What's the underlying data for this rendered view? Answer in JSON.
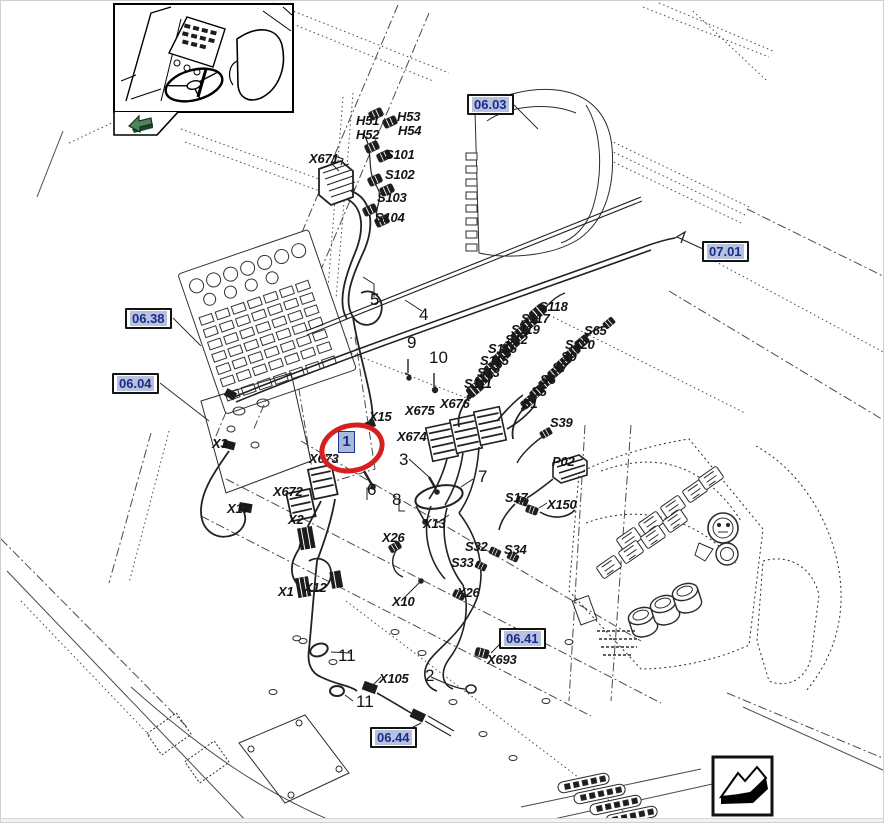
{
  "figure": {
    "type": "wiring-harness-parts-diagram",
    "highlight_callout": {
      "item_label": "1",
      "oval_color": "#d81f1f",
      "label_fill": "#a9b9d9",
      "label_text_color": "#1b2a8c"
    },
    "ref_boxes": [
      {
        "label": "06.03",
        "x": 466,
        "y": 93
      },
      {
        "label": "07.01",
        "x": 701,
        "y": 240
      },
      {
        "label": "06.38",
        "x": 124,
        "y": 307
      },
      {
        "label": "06.04",
        "x": 111,
        "y": 372
      },
      {
        "label": "06.41",
        "x": 498,
        "y": 627
      },
      {
        "label": "06.44",
        "x": 369,
        "y": 726
      }
    ],
    "connector_labels": [
      {
        "text": "H51",
        "x": 355,
        "y": 112
      },
      {
        "text": "H53",
        "x": 396,
        "y": 108
      },
      {
        "text": "H52",
        "x": 355,
        "y": 126
      },
      {
        "text": "H54",
        "x": 397,
        "y": 122
      },
      {
        "text": "X671",
        "x": 308,
        "y": 150
      },
      {
        "text": "S101",
        "x": 384,
        "y": 146
      },
      {
        "text": "S102",
        "x": 384,
        "y": 166
      },
      {
        "text": "S103",
        "x": 376,
        "y": 189
      },
      {
        "text": "S104",
        "x": 374,
        "y": 209
      },
      {
        "text": "S118",
        "x": 538,
        "y": 298
      },
      {
        "text": "S117",
        "x": 520,
        "y": 310
      },
      {
        "text": "S119",
        "x": 510,
        "y": 321
      },
      {
        "text": "S12",
        "x": 504,
        "y": 331
      },
      {
        "text": "S116",
        "x": 487,
        "y": 340
      },
      {
        "text": "S115",
        "x": 479,
        "y": 352
      },
      {
        "text": "S13",
        "x": 476,
        "y": 364
      },
      {
        "text": "S111",
        "x": 463,
        "y": 375
      },
      {
        "text": "S65",
        "x": 583,
        "y": 322
      },
      {
        "text": "S120",
        "x": 564,
        "y": 336
      },
      {
        "text": "S9",
        "x": 560,
        "y": 348
      },
      {
        "text": "S7",
        "x": 551,
        "y": 359
      },
      {
        "text": "S6",
        "x": 539,
        "y": 371
      },
      {
        "text": "S5",
        "x": 530,
        "y": 383
      },
      {
        "text": "S1",
        "x": 521,
        "y": 395
      },
      {
        "text": "S39",
        "x": 549,
        "y": 414
      },
      {
        "text": "X15",
        "x": 368,
        "y": 408
      },
      {
        "text": "X675",
        "x": 404,
        "y": 402
      },
      {
        "text": "X676",
        "x": 439,
        "y": 395
      },
      {
        "text": "X674",
        "x": 396,
        "y": 428
      },
      {
        "text": "X673",
        "x": 308,
        "y": 450
      },
      {
        "text": "X672",
        "x": 272,
        "y": 483
      },
      {
        "text": "X3",
        "x": 211,
        "y": 435
      },
      {
        "text": "X17",
        "x": 226,
        "y": 500
      },
      {
        "text": "X2",
        "x": 287,
        "y": 511
      },
      {
        "text": "X1",
        "x": 277,
        "y": 583
      },
      {
        "text": "X12",
        "x": 303,
        "y": 579
      },
      {
        "text": "X26",
        "x": 381,
        "y": 529
      },
      {
        "text": "X13",
        "x": 422,
        "y": 515
      },
      {
        "text": "S32",
        "x": 464,
        "y": 538
      },
      {
        "text": "S33",
        "x": 450,
        "y": 554
      },
      {
        "text": "S34",
        "x": 503,
        "y": 541
      },
      {
        "text": "X26",
        "x": 456,
        "y": 584
      },
      {
        "text": "X10",
        "x": 391,
        "y": 593
      },
      {
        "text": "P02",
        "x": 551,
        "y": 453
      },
      {
        "text": "S17",
        "x": 504,
        "y": 489
      },
      {
        "text": "X150",
        "x": 546,
        "y": 496
      },
      {
        "text": "X693",
        "x": 486,
        "y": 651
      },
      {
        "text": "X105",
        "x": 378,
        "y": 670
      }
    ],
    "item_numbers": [
      {
        "text": "5",
        "x": 369,
        "y": 289
      },
      {
        "text": "4",
        "x": 418,
        "y": 304
      },
      {
        "text": "9",
        "x": 406,
        "y": 332
      },
      {
        "text": "10",
        "x": 428,
        "y": 347
      },
      {
        "text": "3",
        "x": 398,
        "y": 449
      },
      {
        "text": "6",
        "x": 366,
        "y": 479
      },
      {
        "text": "8",
        "x": 391,
        "y": 489
      },
      {
        "text": "7",
        "x": 477,
        "y": 466
      },
      {
        "text": "11",
        "x": 337,
        "y": 645
      },
      {
        "text": "2",
        "x": 424,
        "y": 665
      },
      {
        "text": "11",
        "x": 355,
        "y": 691
      }
    ],
    "icons": {
      "view_direction_arrow": {
        "name": "view-direction-arrow-icon",
        "color": "#4d8559"
      },
      "continuation_arrow": {
        "name": "continuation-arrow-icon",
        "color": "#000000"
      }
    },
    "colors": {
      "line": "#2b2b2b",
      "background": "#ffffff",
      "ref_text": "#1b2a8c",
      "ref_highlight": "#b7c2de",
      "callout_red": "#d81f1f"
    }
  }
}
